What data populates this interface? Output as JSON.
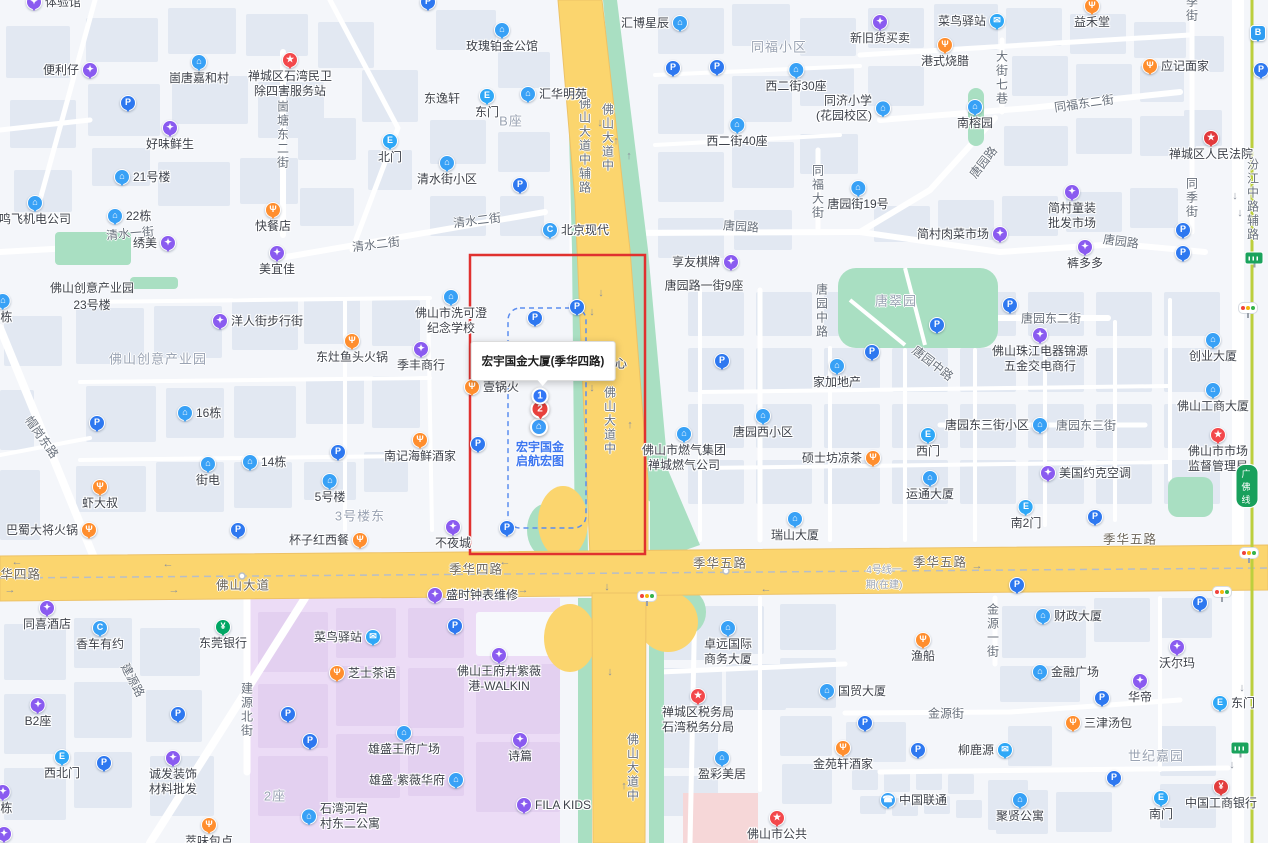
{
  "tooltip": {
    "text": "宏宇国金大厦(季华四路)"
  },
  "selection": {
    "marker1": "1",
    "marker2": "2",
    "poi_line1": "宏宇国金",
    "poi_line2": "启航宏图"
  },
  "metro": {
    "badge": "广佛线"
  },
  "colors": {
    "highlight_box_red": "#e0312f",
    "selection_dash_blue": "#5b8df0",
    "road_yellow": "#fbd56e",
    "road_casing": "#edc267",
    "park_green": "#a9dfc2",
    "zone_purple": "#ecdcf6",
    "zone_purple_block": "#e3d0f0",
    "zone_pink": "#f6d7d8",
    "metro_line_green": "#bccf3d",
    "block_fill": "#e2e8f2",
    "pin_blue": "#2e78f0",
    "pin_light_blue": "#38a1f6",
    "pin_cyan_blue": "#2fa8f7",
    "pin_purple": "#8a5bf0",
    "pin_orange": "#ff8e2e",
    "pin_red": "#f3484b",
    "pin_green": "#00a664",
    "selected_text_blue": "#3d76f0"
  },
  "pois": [
    {
      "x": 34,
      "y": 2,
      "t": "shop",
      "l": "体验馆",
      "p": "r"
    },
    {
      "x": 428,
      "y": 2,
      "t": "p",
      "p": "n"
    },
    {
      "x": 90,
      "y": 70,
      "t": "shop",
      "l": "便利仔",
      "p": "l"
    },
    {
      "x": 199,
      "y": 62,
      "t": "bld",
      "l": "崮唐嘉和村",
      "p": "b"
    },
    {
      "x": 290,
      "y": 60,
      "t": "star",
      "l": "禅城区石湾民卫\n除四害服务站",
      "p": "b"
    },
    {
      "x": 128,
      "y": 103,
      "t": "p",
      "p": "n"
    },
    {
      "x": 170,
      "y": 128,
      "t": "shop",
      "l": "好味鲜生",
      "p": "b"
    },
    {
      "x": 122,
      "y": 177,
      "t": "bld",
      "l": "21号楼",
      "p": "r"
    },
    {
      "x": 35,
      "y": 203,
      "t": "bld",
      "l": "鸣飞机电公司",
      "p": "b"
    },
    {
      "x": 115,
      "y": 216,
      "t": "bld",
      "l": "22栋",
      "p": "r"
    },
    {
      "x": 168,
      "y": 243,
      "t": "shop",
      "l": "绣美",
      "p": "l"
    },
    {
      "x": 273,
      "y": 210,
      "t": "food",
      "l": "快餐店",
      "p": "b"
    },
    {
      "x": 277,
      "y": 253,
      "t": "shop",
      "l": "美宜佳",
      "p": "b"
    },
    {
      "x": 390,
      "y": 141,
      "t": "exit",
      "l": "北门",
      "p": "b"
    },
    {
      "x": 447,
      "y": 163,
      "t": "bld",
      "l": "清水街小区",
      "p": "b"
    },
    {
      "x": 502,
      "y": 30,
      "t": "bld",
      "l": "玫瑰铂金公馆",
      "p": "b"
    },
    {
      "x": 487,
      "y": 96,
      "t": "exit",
      "l": "东门",
      "p": "b"
    },
    {
      "x": 528,
      "y": 94,
      "t": "bld",
      "l": "汇华明苑",
      "p": "r"
    },
    {
      "x": 520,
      "y": 185,
      "t": "p",
      "p": "n"
    },
    {
      "x": 550,
      "y": 230,
      "t": "car",
      "l": "北京现代",
      "p": "r"
    },
    {
      "x": 680,
      "y": 23,
      "t": "bld",
      "l": "汇博星辰",
      "p": "l"
    },
    {
      "x": 673,
      "y": 68,
      "t": "pr",
      "p": "n"
    },
    {
      "x": 717,
      "y": 67,
      "t": "p",
      "p": "n"
    },
    {
      "x": 796,
      "y": 70,
      "t": "bld",
      "l": "西二街30座",
      "p": "b"
    },
    {
      "x": 737,
      "y": 125,
      "t": "bld",
      "l": "西二街40座",
      "p": "b"
    },
    {
      "x": 883,
      "y": 108,
      "t": "bld",
      "l": "同济小学\n(花园校区)",
      "p": "l2"
    },
    {
      "x": 880,
      "y": 22,
      "t": "shop",
      "l": "新旧货买卖",
      "p": "b"
    },
    {
      "x": 997,
      "y": 21,
      "t": "mail",
      "l": "菜鸟驿站",
      "p": "l"
    },
    {
      "x": 1092,
      "y": 6,
      "t": "food",
      "l": "益禾堂",
      "p": "b"
    },
    {
      "x": 945,
      "y": 45,
      "t": "food",
      "l": "港式烧腊",
      "p": "b"
    },
    {
      "x": 1150,
      "y": 66,
      "t": "food",
      "l": "应记面家",
      "p": "r"
    },
    {
      "x": 975,
      "y": 107,
      "t": "bld",
      "l": "南榕园",
      "p": "b"
    },
    {
      "x": 1211,
      "y": 138,
      "t": "gov",
      "l": "禅城区人民法院",
      "p": "b"
    },
    {
      "x": 1258,
      "y": 33,
      "t": "bus",
      "p": "n"
    },
    {
      "x": 1261,
      "y": 70,
      "t": "p",
      "p": "n"
    },
    {
      "x": 858,
      "y": 188,
      "t": "bld",
      "l": "唐园街19号",
      "p": "b"
    },
    {
      "x": 1072,
      "y": 192,
      "t": "shop",
      "l": "简村童装\n批发市场",
      "p": "b"
    },
    {
      "x": 1000,
      "y": 234,
      "t": "shop",
      "l": "简村肉菜市场",
      "p": "l"
    },
    {
      "x": 1085,
      "y": 247,
      "t": "shop",
      "l": "裤多多",
      "p": "b"
    },
    {
      "x": 1183,
      "y": 230,
      "t": "p",
      "p": "n"
    },
    {
      "x": 1183,
      "y": 253,
      "t": "pr",
      "p": "n"
    },
    {
      "x": 731,
      "y": 262,
      "t": "shop",
      "l": "享友棋牌",
      "p": "l"
    },
    {
      "x": 3,
      "y": 301,
      "t": "bld",
      "l": "2栋",
      "p": "b"
    },
    {
      "x": 220,
      "y": 321,
      "t": "shop",
      "l": "洋人街步行街",
      "p": "r"
    },
    {
      "x": 352,
      "y": 341,
      "t": "food",
      "l": "东灶鱼头火锅",
      "p": "b"
    },
    {
      "x": 421,
      "y": 349,
      "t": "shop",
      "l": "季丰商行",
      "p": "b"
    },
    {
      "x": 97,
      "y": 423,
      "t": "p",
      "p": "n"
    },
    {
      "x": 185,
      "y": 413,
      "t": "bld",
      "l": "16栋",
      "p": "r"
    },
    {
      "x": 208,
      "y": 464,
      "t": "bld",
      "l": "街电",
      "p": "b"
    },
    {
      "x": 250,
      "y": 462,
      "t": "bld",
      "l": "14栋",
      "p": "r"
    },
    {
      "x": 338,
      "y": 452,
      "t": "p",
      "p": "n"
    },
    {
      "x": 330,
      "y": 481,
      "t": "bld",
      "l": "5号楼",
      "p": "b"
    },
    {
      "x": 100,
      "y": 487,
      "t": "food",
      "l": "虾大叔",
      "p": "b"
    },
    {
      "x": 89,
      "y": 530,
      "t": "food",
      "l": "巴蜀大将火锅",
      "p": "l"
    },
    {
      "x": 238,
      "y": 530,
      "t": "p",
      "p": "n"
    },
    {
      "x": 360,
      "y": 540,
      "t": "food",
      "l": "杯子红西餐",
      "p": "l"
    },
    {
      "x": 420,
      "y": 440,
      "t": "food",
      "l": "南记海鲜酒家",
      "p": "b"
    },
    {
      "x": 453,
      "y": 527,
      "t": "shop",
      "l": "不夜城",
      "p": "b"
    },
    {
      "x": 507,
      "y": 528,
      "t": "p",
      "p": "n"
    },
    {
      "x": 451,
      "y": 297,
      "t": "bld",
      "l": "佛山市洗可澄\n纪念学校",
      "p": "b"
    },
    {
      "x": 535,
      "y": 318,
      "t": "p",
      "p": "n"
    },
    {
      "x": 577,
      "y": 307,
      "t": "p",
      "p": "n"
    },
    {
      "x": 478,
      "y": 444,
      "t": "p",
      "p": "n"
    },
    {
      "x": 472,
      "y": 387,
      "t": "food",
      "l": "壹锅火",
      "p": "r"
    },
    {
      "x": 684,
      "y": 434,
      "t": "bld",
      "l": "佛山市燃气集团\n禅城燃气公司",
      "p": "b"
    },
    {
      "x": 722,
      "y": 361,
      "t": "p",
      "p": "n"
    },
    {
      "x": 763,
      "y": 416,
      "t": "bld",
      "l": "唐园西小区",
      "p": "b"
    },
    {
      "x": 837,
      "y": 366,
      "t": "bld",
      "l": "家加地产",
      "p": "b"
    },
    {
      "x": 873,
      "y": 458,
      "t": "food",
      "l": "硕士坊凉茶",
      "p": "l"
    },
    {
      "x": 795,
      "y": 519,
      "t": "bld",
      "l": "瑞山大厦",
      "p": "b"
    },
    {
      "x": 937,
      "y": 325,
      "t": "p",
      "p": "n"
    },
    {
      "x": 872,
      "y": 352,
      "t": "p",
      "p": "n"
    },
    {
      "x": 1010,
      "y": 305,
      "t": "p",
      "p": "n"
    },
    {
      "x": 1040,
      "y": 335,
      "t": "shop",
      "l": "佛山珠江电器锦源\n五金交电商行",
      "p": "b"
    },
    {
      "x": 1213,
      "y": 340,
      "t": "bld",
      "l": "创业大厦",
      "p": "b"
    },
    {
      "x": 1213,
      "y": 390,
      "t": "bld",
      "l": "佛山工商大厦",
      "p": "b"
    },
    {
      "x": 1040,
      "y": 425,
      "t": "bld",
      "l": "唐园东三街小区",
      "p": "l"
    },
    {
      "x": 928,
      "y": 435,
      "t": "exit",
      "l": "西门",
      "p": "b"
    },
    {
      "x": 1218,
      "y": 435,
      "t": "star",
      "l": "佛山市市场\n监督管理局",
      "p": "b"
    },
    {
      "x": 1048,
      "y": 473,
      "t": "shop",
      "l": "美国约克空调",
      "p": "r"
    },
    {
      "x": 930,
      "y": 478,
      "t": "bld",
      "l": "运通大厦",
      "p": "b"
    },
    {
      "x": 1026,
      "y": 507,
      "t": "exit",
      "l": "南2门",
      "p": "b"
    },
    {
      "x": 1095,
      "y": 517,
      "t": "p",
      "p": "n"
    },
    {
      "x": 47,
      "y": 608,
      "t": "shop",
      "l": "同喜酒店",
      "p": "b"
    },
    {
      "x": 100,
      "y": 628,
      "t": "car",
      "l": "香车有约",
      "p": "b"
    },
    {
      "x": 223,
      "y": 627,
      "t": "bank",
      "l": "东莞银行",
      "p": "b"
    },
    {
      "x": 373,
      "y": 637,
      "t": "mail",
      "l": "菜鸟驿站",
      "p": "l"
    },
    {
      "x": 337,
      "y": 673,
      "t": "food",
      "l": "芝士茶语",
      "p": "r"
    },
    {
      "x": 38,
      "y": 705,
      "t": "shop",
      "l": "B2座",
      "p": "b"
    },
    {
      "x": 178,
      "y": 714,
      "t": "p",
      "p": "n"
    },
    {
      "x": 288,
      "y": 714,
      "t": "pr",
      "p": "n"
    },
    {
      "x": 310,
      "y": 741,
      "t": "p",
      "p": "n"
    },
    {
      "x": 404,
      "y": 733,
      "t": "bld",
      "l": "雄盛王府广场",
      "p": "b"
    },
    {
      "x": 62,
      "y": 757,
      "t": "exit",
      "l": "西北门",
      "p": "b"
    },
    {
      "x": 104,
      "y": 763,
      "t": "p",
      "p": "n"
    },
    {
      "x": 173,
      "y": 758,
      "t": "shop",
      "l": "诚发装饰\n材料批发",
      "p": "b"
    },
    {
      "x": 456,
      "y": 780,
      "t": "bld",
      "l": "雄盛·紫薇华府",
      "p": "l"
    },
    {
      "x": 3,
      "y": 792,
      "t": "shop",
      "l": "6栋",
      "p": "b"
    },
    {
      "x": 4,
      "y": 834,
      "t": "shop",
      "p": "n"
    },
    {
      "x": 209,
      "y": 825,
      "t": "food",
      "l": "萃味包点",
      "p": "b"
    },
    {
      "x": 309,
      "y": 816,
      "t": "bld",
      "l": "石湾河宕\n村东二公寓",
      "p": "r2"
    },
    {
      "x": 435,
      "y": 595,
      "t": "shop",
      "l": "盛时钟表维修",
      "p": "r"
    },
    {
      "x": 455,
      "y": 626,
      "t": "pr",
      "p": "n"
    },
    {
      "x": 499,
      "y": 655,
      "t": "shop",
      "l": "佛山王府井紫薇\n港-WALKIN",
      "p": "b"
    },
    {
      "x": 520,
      "y": 740,
      "t": "shop",
      "l": "诗篇",
      "p": "b"
    },
    {
      "x": 524,
      "y": 805,
      "t": "shop",
      "l": "FILA KIDS",
      "p": "r"
    },
    {
      "x": 728,
      "y": 628,
      "t": "bld",
      "l": "卓远国际\n商务大厦",
      "p": "b"
    },
    {
      "x": 698,
      "y": 696,
      "t": "star",
      "l": "禅城区税务局\n石湾税务分局",
      "p": "b"
    },
    {
      "x": 722,
      "y": 758,
      "t": "bld",
      "l": "盈彩美居",
      "p": "b"
    },
    {
      "x": 843,
      "y": 748,
      "t": "food",
      "l": "金苑轩酒家",
      "p": "b"
    },
    {
      "x": 827,
      "y": 691,
      "t": "bld",
      "l": "国贸大厦",
      "p": "r"
    },
    {
      "x": 777,
      "y": 818,
      "t": "star",
      "l": "佛山市公共",
      "p": "b"
    },
    {
      "x": 1017,
      "y": 585,
      "t": "p",
      "p": "n"
    },
    {
      "x": 1043,
      "y": 616,
      "t": "bld",
      "l": "财政大厦",
      "p": "r"
    },
    {
      "x": 1200,
      "y": 603,
      "t": "p",
      "p": "n"
    },
    {
      "x": 923,
      "y": 640,
      "t": "food",
      "l": "渔船",
      "p": "b"
    },
    {
      "x": 1177,
      "y": 647,
      "t": "shop",
      "l": "沃尔玛",
      "p": "b"
    },
    {
      "x": 1040,
      "y": 672,
      "t": "bld",
      "l": "金融广场",
      "p": "r"
    },
    {
      "x": 1140,
      "y": 681,
      "t": "shop",
      "l": "华帝",
      "p": "b"
    },
    {
      "x": 1102,
      "y": 698,
      "t": "p",
      "p": "n"
    },
    {
      "x": 1220,
      "y": 703,
      "t": "exit",
      "l": "东门",
      "p": "r"
    },
    {
      "x": 865,
      "y": 723,
      "t": "p",
      "p": "n"
    },
    {
      "x": 1073,
      "y": 723,
      "t": "food",
      "l": "三津汤包",
      "p": "r"
    },
    {
      "x": 918,
      "y": 750,
      "t": "p",
      "p": "n"
    },
    {
      "x": 1005,
      "y": 750,
      "t": "mail",
      "l": "柳鹿源",
      "p": "l"
    },
    {
      "x": 1114,
      "y": 778,
      "t": "p",
      "p": "n"
    },
    {
      "x": 888,
      "y": 800,
      "t": "tel",
      "l": "中国联通",
      "p": "r"
    },
    {
      "x": 1020,
      "y": 800,
      "t": "bld",
      "l": "聚贤公寓",
      "p": "b"
    },
    {
      "x": 1161,
      "y": 798,
      "t": "exit",
      "l": "南门",
      "p": "b"
    },
    {
      "x": 1221,
      "y": 787,
      "t": "rbank",
      "l": "中国工商银行",
      "p": "b"
    }
  ],
  "labels": [
    {
      "x": 92,
      "y": 296,
      "l": "佛山创意产业园\n23号楼",
      "k": "dark"
    },
    {
      "x": 442,
      "y": 98,
      "l": "东逸轩",
      "k": "dark"
    },
    {
      "x": 704,
      "y": 285,
      "l": "唐园路一街9座",
      "k": "dark"
    },
    {
      "x": 615,
      "y": 363,
      "l": "中心",
      "k": "dark"
    },
    {
      "x": 158,
      "y": 358,
      "l": "佛山创意产业园",
      "k": "area"
    },
    {
      "x": 360,
      "y": 515,
      "l": "3号楼东",
      "k": "area"
    },
    {
      "x": 779,
      "y": 46,
      "l": "同福小区",
      "k": "area"
    },
    {
      "x": 511,
      "y": 120,
      "l": "B座",
      "k": "area"
    },
    {
      "x": 896,
      "y": 300,
      "l": "唐翠园",
      "k": "area"
    },
    {
      "x": 1156,
      "y": 755,
      "l": "世纪嘉园",
      "k": "area"
    },
    {
      "x": 275,
      "y": 795,
      "l": "2座",
      "k": "area"
    },
    {
      "x": 884,
      "y": 576,
      "l": "4号线一\n期(在建)",
      "k": "areasm"
    },
    {
      "x": 376,
      "y": 244,
      "l": "清水二街",
      "k": "road",
      "r": -7
    },
    {
      "x": 477,
      "y": 220,
      "l": "清水二街",
      "k": "road",
      "r": -7
    },
    {
      "x": 130,
      "y": 233,
      "l": "清水一街",
      "k": "road",
      "r": -5
    },
    {
      "x": 283,
      "y": 135,
      "l": "崮塘东二街",
      "k": "roadv"
    },
    {
      "x": 818,
      "y": 192,
      "l": "同福大街",
      "k": "roadv"
    },
    {
      "x": 1192,
      "y": 198,
      "l": "同季街",
      "k": "roadv"
    },
    {
      "x": 1192,
      "y": 9,
      "l": "季街",
      "k": "roadv"
    },
    {
      "x": 1253,
      "y": 200,
      "l": "汾江中路辅路",
      "k": "roadv"
    },
    {
      "x": 1002,
      "y": 78,
      "l": "大街七巷",
      "k": "roadv"
    },
    {
      "x": 585,
      "y": 146,
      "l": "佛山大道中辅路",
      "k": "roadv"
    },
    {
      "x": 608,
      "y": 138,
      "l": "佛山大道中",
      "k": "roadv"
    },
    {
      "x": 610,
      "y": 421,
      "l": "佛山大道中",
      "k": "roadv"
    },
    {
      "x": 633,
      "y": 768,
      "l": "佛山大道中",
      "k": "roadv"
    },
    {
      "x": 741,
      "y": 226,
      "l": "唐园路",
      "k": "road",
      "r": 4
    },
    {
      "x": 983,
      "y": 162,
      "l": "唐园路",
      "k": "road",
      "r": -52
    },
    {
      "x": 1121,
      "y": 241,
      "l": "唐园路",
      "k": "road",
      "r": 8
    },
    {
      "x": 1084,
      "y": 103,
      "l": "同福东二街",
      "k": "road",
      "r": -8
    },
    {
      "x": 1051,
      "y": 318,
      "l": "唐园东二街",
      "k": "road"
    },
    {
      "x": 1086,
      "y": 425,
      "l": "唐园东三街",
      "k": "road"
    },
    {
      "x": 933,
      "y": 363,
      "l": "唐园中路",
      "k": "road",
      "r": 38
    },
    {
      "x": 822,
      "y": 311,
      "l": "唐园中路",
      "k": "roadv"
    },
    {
      "x": 133,
      "y": 680,
      "l": "建源路",
      "k": "road",
      "r": 62
    },
    {
      "x": 247,
      "y": 710,
      "l": "建源北街",
      "k": "roadv"
    },
    {
      "x": 42,
      "y": 437,
      "l": "帽岗东路",
      "k": "road",
      "r": 55
    },
    {
      "x": 993,
      "y": 631,
      "l": "金源一街",
      "k": "roadv"
    },
    {
      "x": 946,
      "y": 713,
      "l": "金源街",
      "k": "road"
    },
    {
      "x": 14,
      "y": 573,
      "l": "季华四路",
      "k": "hwy"
    },
    {
      "x": 476,
      "y": 568,
      "l": "季华四路",
      "k": "hwy"
    },
    {
      "x": 243,
      "y": 584,
      "l": "佛山大道",
      "k": "hwy"
    },
    {
      "x": 720,
      "y": 562,
      "l": "季华五路",
      "k": "hwy"
    },
    {
      "x": 940,
      "y": 561,
      "l": "季华五路",
      "k": "hwy"
    },
    {
      "x": 1130,
      "y": 538,
      "l": "季华五路",
      "k": "hwy"
    }
  ],
  "arrows": [
    {
      "x": 17,
      "y": 562,
      "d": "l"
    },
    {
      "x": 10,
      "y": 590,
      "d": "r"
    },
    {
      "x": 168,
      "y": 564,
      "d": "l"
    },
    {
      "x": 174,
      "y": 590,
      "d": "r"
    },
    {
      "x": 505,
      "y": 562,
      "d": "l"
    },
    {
      "x": 523,
      "y": 590,
      "d": "r"
    },
    {
      "x": 766,
      "y": 589,
      "d": "l"
    },
    {
      "x": 977,
      "y": 566,
      "d": "r"
    },
    {
      "x": 600,
      "y": 123,
      "d": "d"
    },
    {
      "x": 616,
      "y": 141,
      "d": "u"
    },
    {
      "x": 629,
      "y": 156,
      "d": "u"
    },
    {
      "x": 601,
      "y": 293,
      "d": "d"
    },
    {
      "x": 592,
      "y": 312,
      "d": "d"
    },
    {
      "x": 592,
      "y": 388,
      "d": "d"
    },
    {
      "x": 630,
      "y": 425,
      "d": "u"
    },
    {
      "x": 607,
      "y": 587,
      "d": "d"
    },
    {
      "x": 610,
      "y": 672,
      "d": "d"
    },
    {
      "x": 624,
      "y": 786,
      "d": "u"
    },
    {
      "x": 1235,
      "y": 196,
      "d": "d"
    },
    {
      "x": 1240,
      "y": 213,
      "d": "d"
    },
    {
      "x": 1242,
      "y": 688,
      "d": "d"
    },
    {
      "x": 1232,
      "y": 765,
      "d": "d"
    }
  ],
  "widgets": {
    "traffic_lights": [
      {
        "x": 647,
        "y": 596
      },
      {
        "x": 1222,
        "y": 592
      },
      {
        "x": 1248,
        "y": 308
      },
      {
        "x": 1249,
        "y": 553
      }
    ],
    "metro_stations": [
      {
        "x": 1254,
        "y": 258
      },
      {
        "x": 1240,
        "y": 748
      }
    ]
  }
}
